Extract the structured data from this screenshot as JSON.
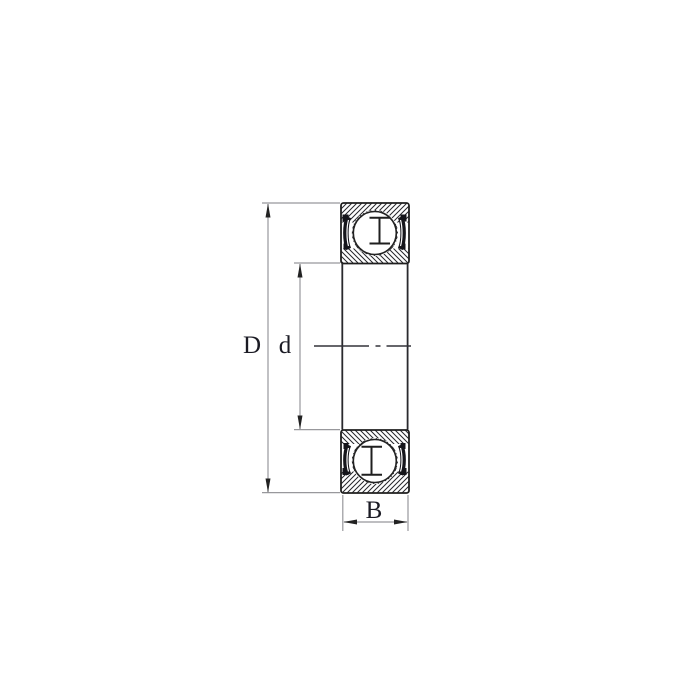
{
  "diagram": {
    "kind": "ball-bearing-cross-section",
    "labels": {
      "outer_diameter": "D",
      "bore_diameter": "d",
      "width": "B"
    },
    "colors": {
      "background": "#ffffff",
      "outline": "#1f1f1f",
      "hatch": "#26262b",
      "seal": "#15151a",
      "dimension_line": "#98989c",
      "arrowhead": "#222222",
      "label_text": "#1b1b24"
    }
  }
}
